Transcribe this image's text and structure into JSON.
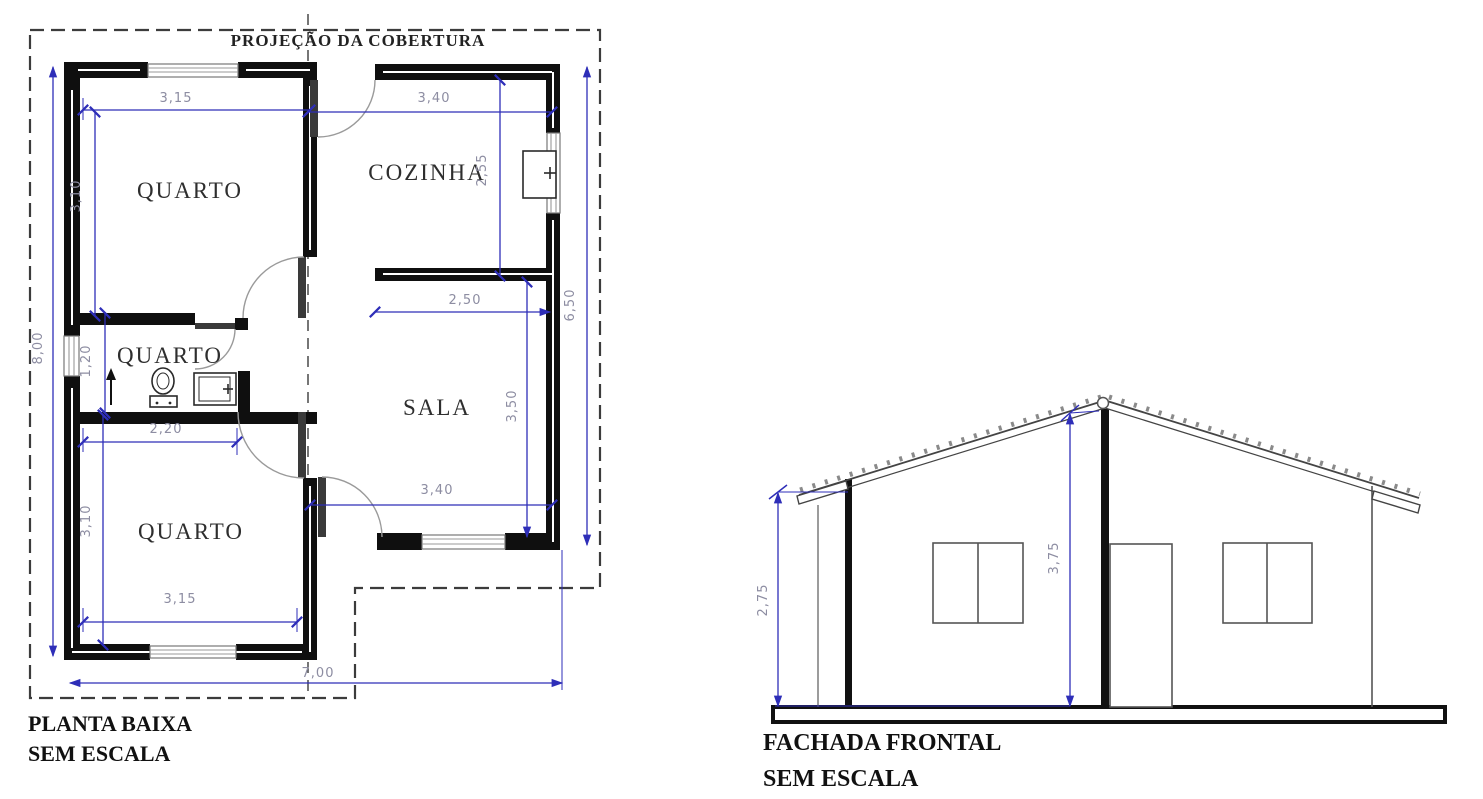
{
  "floor_plan": {
    "title": "PLANTA BAIXA",
    "scale_note": "SEM ESCALA",
    "roof_label": "PROJEÇÃO DA COBERTURA",
    "rooms": [
      {
        "label": "QUARTO"
      },
      {
        "label": "COZINHA"
      },
      {
        "label": "QUARTO"
      },
      {
        "label": "SALA"
      },
      {
        "label": "QUARTO"
      }
    ],
    "dims": {
      "quarto1_width": "3,15",
      "cozinha_width": "3,40",
      "cozinha_depth": "2,55",
      "quarto1_depth": "3,10",
      "sala_top_wall": "2,50",
      "right_side_depth": "6,50",
      "sala_depth": "3,50",
      "sala_width": "3,40",
      "banheiro_depth": "1,20",
      "banheiro_width": "2,20",
      "quarto2_depth": "3,10",
      "quarto2_width": "3,15",
      "total_depth": "8,00",
      "total_width": "7,00"
    }
  },
  "facade": {
    "title": "FACHADA FRONTAL",
    "scale_note": "SEM ESCALA",
    "dims": {
      "wall_height": "2,75",
      "ridge_height": "3,75"
    }
  },
  "colors": {
    "dimension_line": "#2e2eb8",
    "dimension_text": "#8d8da2",
    "wall": "#0f0f0f",
    "dashed_outline": "#3c3c3c"
  }
}
